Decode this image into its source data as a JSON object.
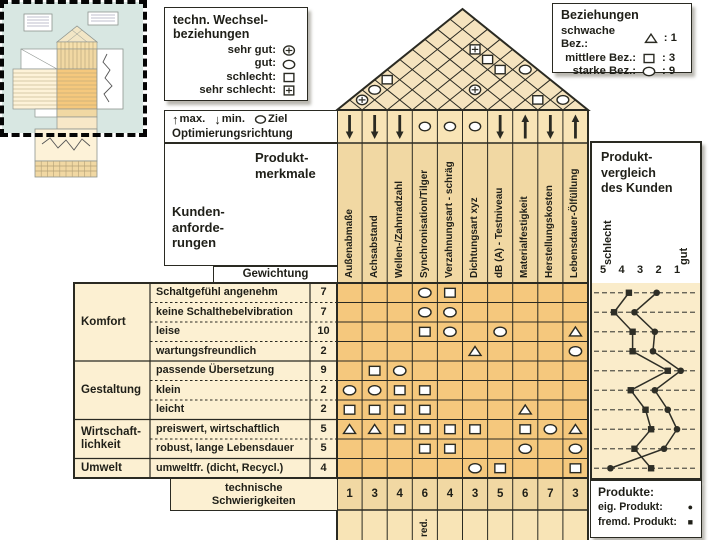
{
  "legend_tech": {
    "title_lines": [
      "techn. Wechsel-",
      "beziehungen"
    ],
    "items": [
      {
        "label": "sehr gut:",
        "symbol": "circle-plus"
      },
      {
        "label": "gut:",
        "symbol": "circle"
      },
      {
        "label": "schlecht:",
        "symbol": "square"
      },
      {
        "label": "sehr schlecht:",
        "symbol": "square-plus"
      }
    ]
  },
  "legend_relations": {
    "title": "Beziehungen",
    "items": [
      {
        "label": "schwache Bez.:",
        "symbol": "triangle",
        "value": ": 1"
      },
      {
        "label": "mittlere Bez.:",
        "symbol": "square",
        "value": ": 3"
      },
      {
        "label": "starke Bez.:",
        "symbol": "circle",
        "value": ": 9"
      }
    ]
  },
  "optimization": {
    "items": [
      {
        "symbol": "up-arrow",
        "label": "max."
      },
      {
        "symbol": "down-arrow",
        "label": "min."
      },
      {
        "symbol": "circle",
        "label": "Ziel"
      }
    ],
    "title": "Optimierungsrichtung"
  },
  "corner": {
    "product_lines": [
      "Produkt-",
      "merkmale"
    ],
    "customer_lines": [
      "Kunden-",
      "anforde-",
      "rungen"
    ],
    "weight_header": "Gewichtung"
  },
  "columns": [
    {
      "label": "Außenabmaße",
      "direction": "down",
      "difficulty": "1"
    },
    {
      "label": "Achsabstand",
      "direction": "down",
      "difficulty": "3"
    },
    {
      "label": "Wellen-/Zahnradzahl",
      "direction": "down",
      "difficulty": "4"
    },
    {
      "label": "Synchronisation/Tilger",
      "direction": "target",
      "difficulty": "6"
    },
    {
      "label": "Verzahnungsart - schräg",
      "direction": "target",
      "difficulty": "4"
    },
    {
      "label": "Dichtungsart xyz",
      "direction": "target",
      "difficulty": "3"
    },
    {
      "label": "dB (A) - Testniveau",
      "direction": "down",
      "difficulty": "5"
    },
    {
      "label": "Materialfestigkeit",
      "direction": "up",
      "difficulty": "6"
    },
    {
      "label": "Herstellungskosten",
      "direction": "down",
      "difficulty": "7"
    },
    {
      "label": "Lebensdauer-Ölfüllung",
      "direction": "up",
      "difficulty": "3"
    }
  ],
  "row_groups": [
    {
      "label_lines": [
        "Komfort"
      ],
      "span": [
        1,
        4
      ]
    },
    {
      "label_lines": [
        "Gestaltung"
      ],
      "span": [
        5,
        7
      ]
    },
    {
      "label_lines": [
        "Wirtschaft-",
        "lichkeit"
      ],
      "span": [
        8,
        9
      ]
    },
    {
      "label_lines": [
        "Umwelt"
      ],
      "span": [
        10,
        10
      ]
    }
  ],
  "rows": [
    {
      "label": "Schaltgefühl angenehm",
      "weight": "7",
      "relations": [
        "",
        "",
        "",
        "circle",
        "square",
        "",
        "",
        "",
        "",
        ""
      ]
    },
    {
      "label": "keine Schalthebelvibration",
      "weight": "7",
      "relations": [
        "",
        "",
        "",
        "circle",
        "circle",
        "",
        "",
        "",
        "",
        ""
      ]
    },
    {
      "label": "leise",
      "weight": "10",
      "relations": [
        "",
        "",
        "",
        "square",
        "circle",
        "",
        "circle",
        "",
        "",
        "triangle"
      ]
    },
    {
      "label": "wartungsfreundlich",
      "weight": "2",
      "relations": [
        "",
        "",
        "",
        "",
        "",
        "triangle",
        "",
        "",
        "",
        "circle"
      ]
    },
    {
      "label": "passende Übersetzung",
      "weight": "9",
      "relations": [
        "",
        "square",
        "circle",
        "",
        "",
        "",
        "",
        "",
        "",
        ""
      ]
    },
    {
      "label": "klein",
      "weight": "2",
      "relations": [
        "circle",
        "circle",
        "square",
        "square",
        "",
        "",
        "",
        "",
        "",
        ""
      ]
    },
    {
      "label": "leicht",
      "weight": "2",
      "relations": [
        "square",
        "square",
        "square",
        "square",
        "",
        "",
        "",
        "triangle",
        "",
        ""
      ]
    },
    {
      "label": "preiswert, wirtschaftlich",
      "weight": "5",
      "relations": [
        "triangle",
        "triangle",
        "square",
        "square",
        "square",
        "square",
        "",
        "square",
        "circle",
        "triangle"
      ]
    },
    {
      "label": "robust, lange Lebensdauer",
      "weight": "5",
      "relations": [
        "",
        "",
        "",
        "square",
        "square",
        "",
        "",
        "circle",
        "",
        "circle"
      ]
    },
    {
      "label": "umweltfr. (dicht, Recycl.)",
      "weight": "4",
      "relations": [
        "",
        "",
        "",
        "",
        "",
        "circle",
        "square",
        "",
        "",
        "square"
      ]
    }
  ],
  "roof_correlations": [
    {
      "cols": [
        1,
        2
      ],
      "symbol": "circle-plus"
    },
    {
      "cols": [
        1,
        3
      ],
      "symbol": "circle"
    },
    {
      "cols": [
        1,
        4
      ],
      "symbol": "square"
    },
    {
      "cols": [
        5,
        7
      ],
      "symbol": "circle-plus"
    },
    {
      "cols": [
        3,
        9
      ],
      "symbol": "square-plus"
    },
    {
      "cols": [
        4,
        9
      ],
      "symbol": "square"
    },
    {
      "cols": [
        5,
        9
      ],
      "symbol": "square"
    },
    {
      "cols": [
        6,
        10
      ],
      "symbol": "circle"
    },
    {
      "cols": [
        8,
        9
      ],
      "symbol": "square"
    },
    {
      "cols": [
        9,
        10
      ],
      "symbol": "circle"
    }
  ],
  "difficulty_label_lines": [
    "technische",
    "Schwierigkeiten"
  ],
  "sub_row": {
    "col4_note": "red."
  },
  "product_comparison": {
    "title_lines": [
      "Produkt-",
      "vergleich",
      "des Kunden"
    ],
    "left_label": "schlecht",
    "right_label": "gut",
    "scale_ticks": [
      "5",
      "4",
      "3",
      "2",
      "1"
    ],
    "series": [
      {
        "name": "eig. Produkt",
        "marker": "circle",
        "values": [
          2.1,
          3.3,
          2.2,
          2.3,
          0.8,
          2.2,
          1.5,
          1.0,
          1.7,
          4.6
        ]
      },
      {
        "name": "fremd. Produkt",
        "marker": "square",
        "values": [
          3.6,
          4.4,
          3.4,
          3.4,
          1.5,
          3.5,
          2.7,
          2.4,
          3.3,
          2.4
        ]
      }
    ]
  },
  "products_legend": {
    "title": "Produkte:",
    "items": [
      {
        "label": "eig. Produkt:",
        "marker": "circle"
      },
      {
        "label": "fremd. Produkt:",
        "marker": "square"
      }
    ]
  },
  "chart_data": {
    "type": "line",
    "title": "Produktvergleich des Kunden",
    "categories": [
      "Schaltgefühl angenehm",
      "keine Schalthebelvibration",
      "leise",
      "wartungsfreundlich",
      "passende Übersetzung",
      "klein",
      "leicht",
      "preiswert, wirtschaftlich",
      "robust, lange Lebensdauer",
      "umweltfr. (dicht, Recycl.)"
    ],
    "series": [
      {
        "name": "eig. Produkt",
        "marker": "circle",
        "values": [
          2.1,
          3.3,
          2.2,
          2.3,
          0.8,
          2.2,
          1.5,
          1.0,
          1.7,
          4.6
        ]
      },
      {
        "name": "fremd. Produkt",
        "marker": "square",
        "values": [
          3.6,
          4.4,
          3.4,
          3.4,
          1.5,
          3.5,
          2.7,
          2.4,
          3.3,
          2.4
        ]
      }
    ],
    "xlabel": "Bewertung (5 = schlecht, 1 = gut)",
    "xlim": [
      5,
      1
    ],
    "grid": "dashed-horizontal",
    "legend_position": "bottom-right"
  },
  "colors": {
    "cream": "#fcf0d2",
    "tan": "#f1d8a3",
    "light_tan": "#f8e4b6",
    "matrix_orange": "#f5c87d",
    "roof": "#f5e3be",
    "chart_bg": "#faecca",
    "line": "#2a2a22",
    "thumb_blue": "#d8e7e2"
  }
}
